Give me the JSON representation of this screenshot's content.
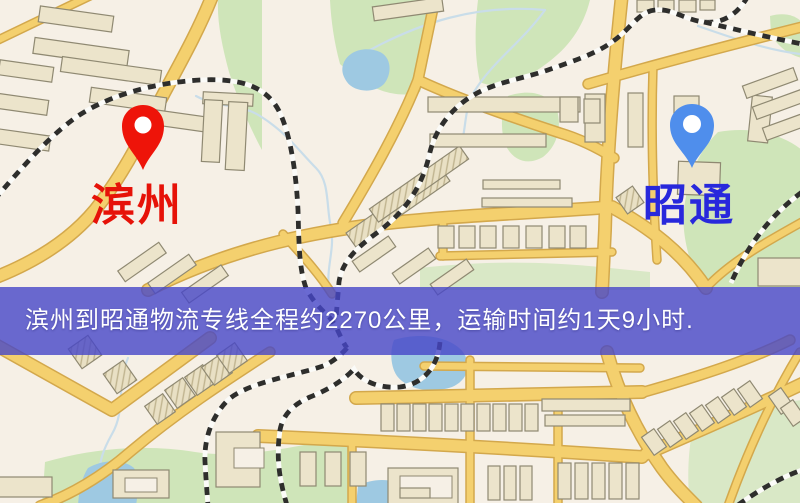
{
  "page": {
    "width_px": 800,
    "height_px": 503
  },
  "map": {
    "origin": {
      "name": "滨州",
      "label_color": "#e61208",
      "pin_color": "#ee1409",
      "pin_icon": "map-pin-icon"
    },
    "destination": {
      "name": "昭通",
      "label_color": "#2828dc",
      "pin_color": "#4f8eec",
      "pin_icon": "map-pin-icon"
    },
    "banner": {
      "text": "滨州到昭通物流专线全程约2270公里，运输时间约1天9小时.",
      "distance_text": "约2270公里",
      "duration_text": "约1天9小时",
      "bg_color": "#4646c8",
      "text_color": "#ffffff"
    },
    "palette": {
      "background": "#f6f0e6",
      "road": "#f4d06e",
      "road_casing": "#d3a84c",
      "park": "#cfe5b9",
      "water": "#9ec9e2",
      "railway": "#2e2e2c",
      "building": "#ece4cb"
    }
  }
}
